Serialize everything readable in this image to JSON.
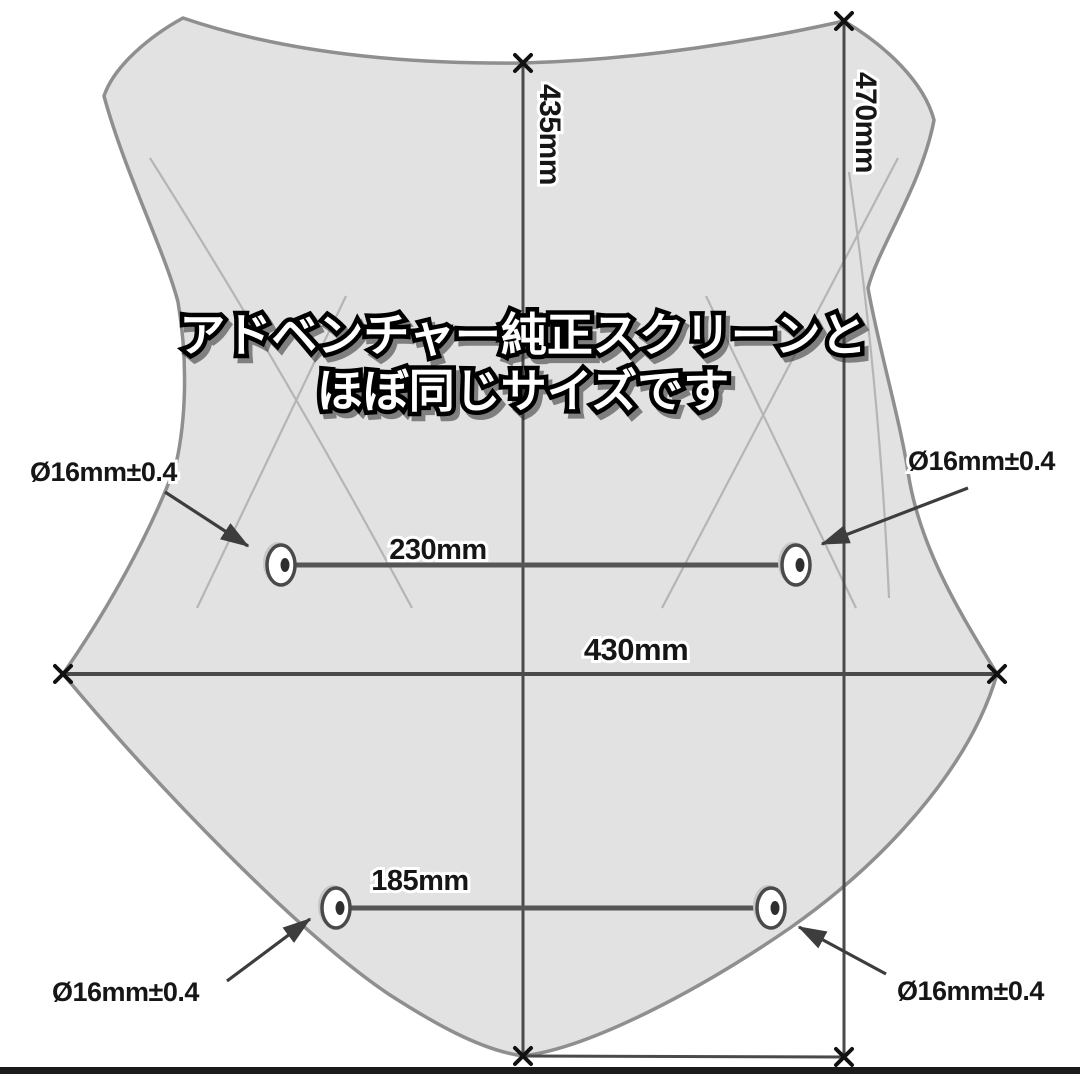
{
  "caption": {
    "line1": "アドベンチャー純正スクリーンと",
    "line2": "ほぼ同じサイズです"
  },
  "dimensions": {
    "center_height": "435mm",
    "right_height": "470mm",
    "max_width": "430mm",
    "upper_hole_spacing": "230mm",
    "lower_hole_spacing": "185mm",
    "hole_upper_left": "Ø16mm±0.4",
    "hole_upper_right": "Ø16mm±0.4",
    "hole_lower_left": "Ø16mm±0.4",
    "hole_lower_right": "Ø16mm±0.4"
  },
  "colors": {
    "shape_fill": "#e2e2e2",
    "shape_stroke": "#8f8f8f",
    "dimension_line": "#4a4a4a",
    "label_text": "#161616",
    "caption_fill": "#ffffff",
    "caption_outline": "#000000",
    "bottom_bar": "#1b1b1b"
  }
}
